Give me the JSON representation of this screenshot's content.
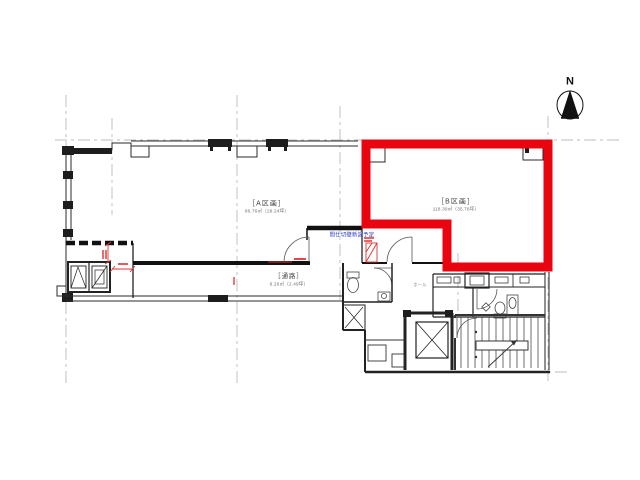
{
  "north": {
    "label": "N"
  },
  "rooms": {
    "a": {
      "name": "［A区画］",
      "area": "86.76㎡（26.24坪）"
    },
    "b": {
      "name": "［B区画］",
      "area": "118.30㎡（35.78坪）"
    },
    "corridor": {
      "name": "［通路］",
      "area": "8.26㎡（2.49坪）"
    },
    "hall": {
      "name": "ホール"
    }
  },
  "annotations": {
    "partition_note": "間仕切壁新設予定"
  },
  "colors": {
    "highlight_red": "#e80510",
    "annotation_blue": "#2437c8",
    "dimension_red": "#e03131",
    "line_dark": "#2b2b2b",
    "grid_gray": "#a0a0a0"
  }
}
